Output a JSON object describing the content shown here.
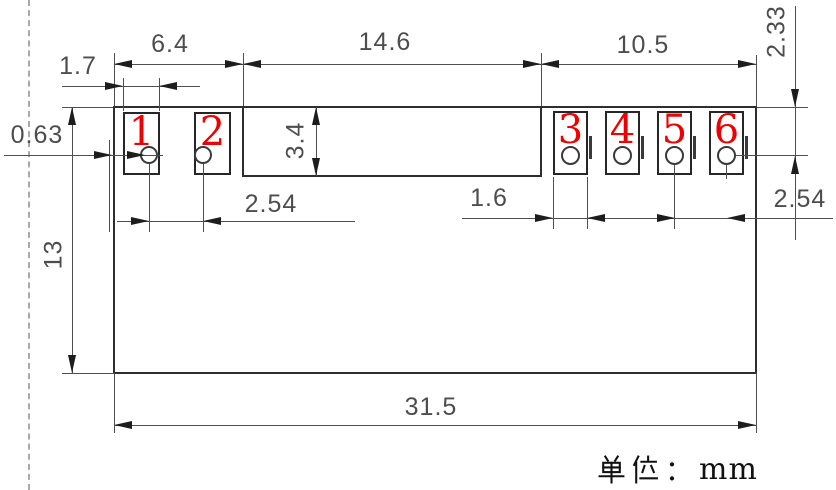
{
  "unit_label": {
    "text": "单位：mm",
    "hanzi": "单位",
    "colon": "：",
    "unit": "mm"
  },
  "pins": [
    {
      "number": "1"
    },
    {
      "number": "2"
    },
    {
      "number": "3"
    },
    {
      "number": "4"
    },
    {
      "number": "5"
    },
    {
      "number": "6"
    }
  ],
  "dimensions": {
    "section_left": "6.4",
    "section_middle": "14.6",
    "section_right": "10.5",
    "pad_width_left": "1.7",
    "edge_offset": "0.63",
    "notch_depth": "3.4",
    "body_height": "13",
    "pitch_left": "2.54",
    "pad_width_right": "1.6",
    "pitch_right": "2.54",
    "top_to_hole": "2.33",
    "overall_width": "31.5"
  },
  "colors": {
    "pin_number": "#ee0000",
    "outline": "#2e2e2e",
    "dimension": "#4d4d4d",
    "datum_dash": "#a9a9a9"
  }
}
